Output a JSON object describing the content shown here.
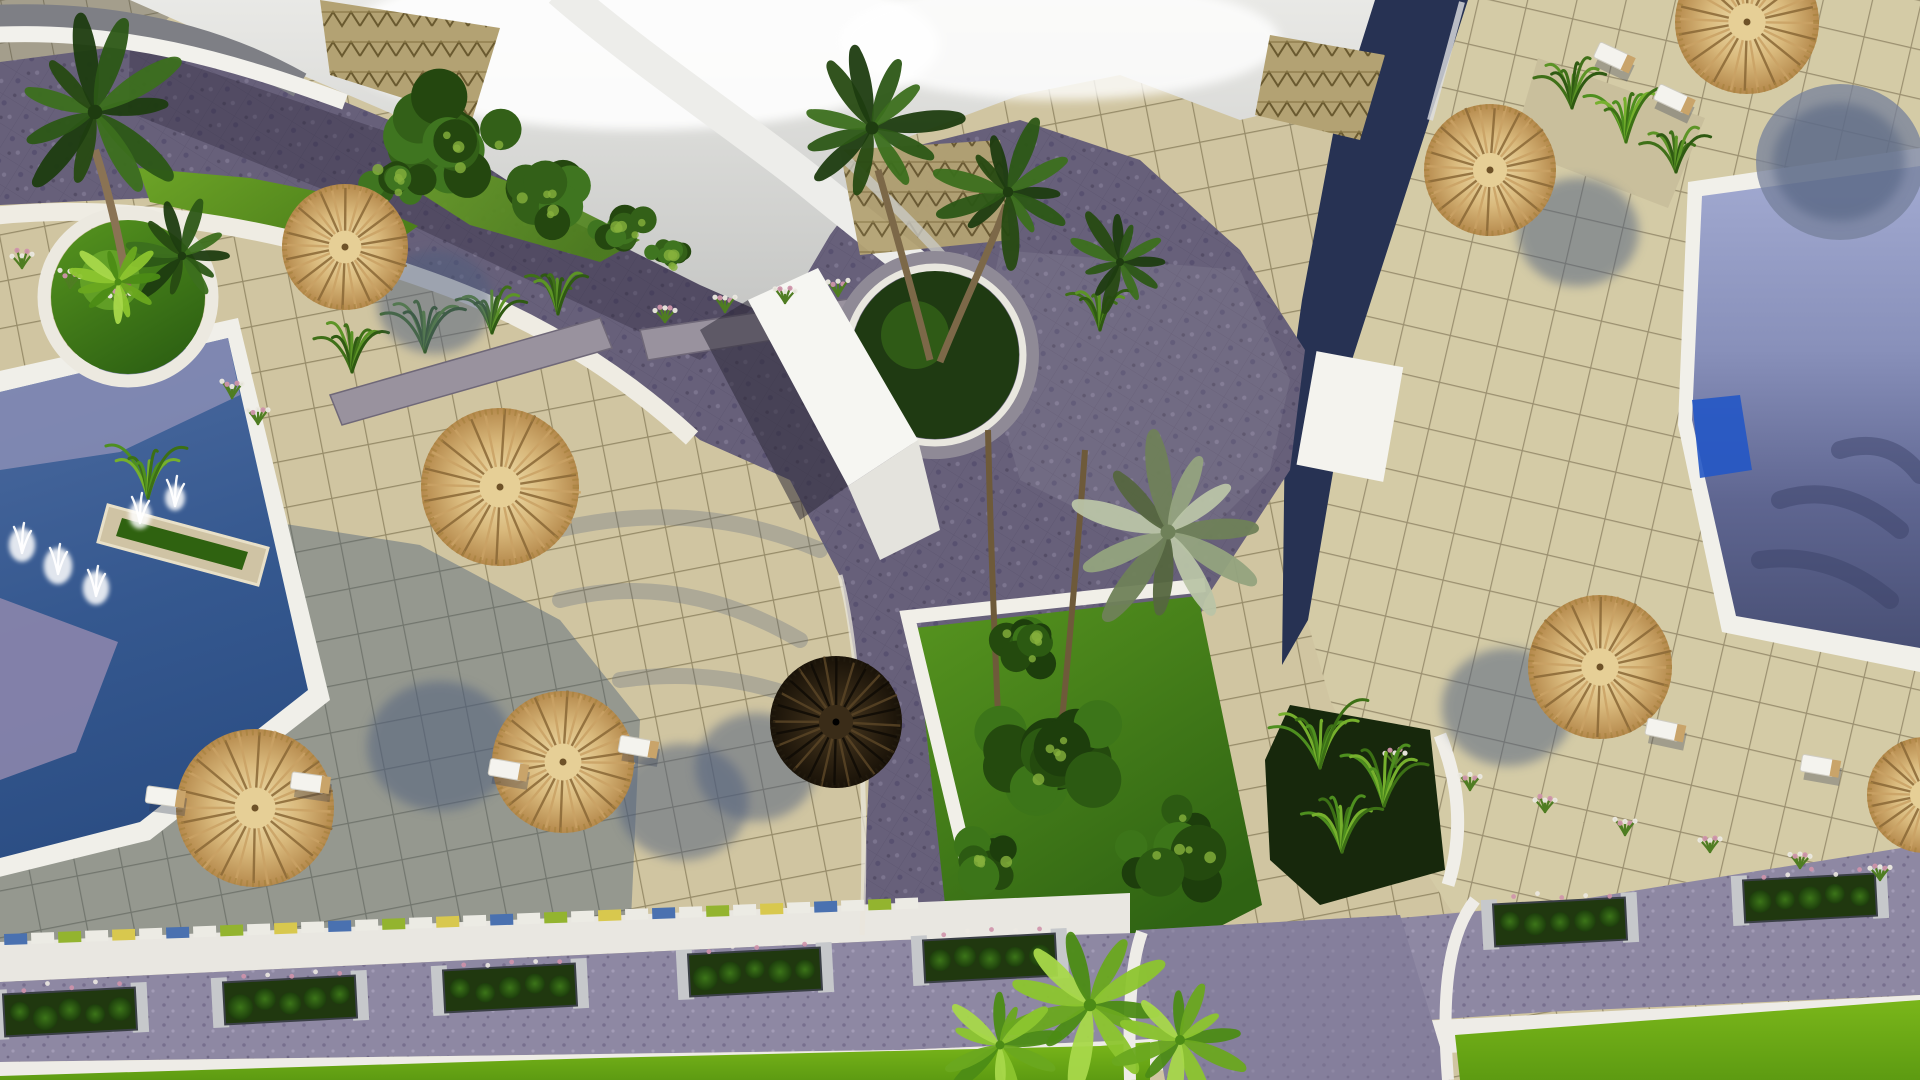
{
  "meta": {
    "title": "aerial-3d-render-resort-pools",
    "description": "Top-down architectural rendering of a resort courtyard with swimming pools, thatched parasols, palm trees, tiled terraces, cobblestone walkways and a landscaped road"
  },
  "palette": {
    "tile_beige": "#cdc29c",
    "tile_grout": "#978c69",
    "tile_right": "#d4cba6",
    "cobble": "#67607a",
    "road": "#8e88a3",
    "navy_path": "#273253",
    "white_curb": "#efede6",
    "pool_deep": "#2d4f86",
    "pool_light": "#9aa2ca",
    "pool_lavender": "#8d90b6",
    "lawn": "#67a024",
    "lawn_bright": "#6fae14",
    "garden": "#2f6313",
    "straw_light": "#efe0ae",
    "straw_dark": "#b5894c",
    "umbrella_spoke_dark": "#8a6836",
    "umbrella_spoke_light": "#caa265",
    "roof_tan": "#b3a273",
    "sky": "#d8d8d5",
    "tree": [
      "#24470f",
      "#336018",
      "#3f7520"
    ],
    "palm": {
      "dark": [
        "#1e3c10",
        "#2c5716",
        "#3c6f1d",
        "#274a12"
      ],
      "silver": [
        "#6f8159",
        "#93a37e",
        "#b9c4a6",
        "#55663f"
      ],
      "bright": [
        "#4c8c15",
        "#6aa81f",
        "#8cc52e",
        "#a8d84a"
      ],
      "garden": [
        "#1d3e0c",
        "#2c5a12",
        "#3c7519",
        "#244a0e"
      ]
    },
    "fern": [
      "#3f7018",
      "#5c9426",
      "#2f5a12"
    ],
    "fern_bright": [
      "#4e8f1f",
      "#76b02d",
      "#3c7015"
    ],
    "flower_pink": "#cf93ab",
    "flower_white": "#ece9e2",
    "trim_colors": [
      "#4a71b0",
      "#ecebe4",
      "#93b42f",
      "#ecebe4",
      "#d8c84e",
      "#ecebe4"
    ]
  },
  "scene": {
    "umbrellas": [
      {
        "x": 345,
        "y": 247,
        "r": 63,
        "style": "straw",
        "sh": [
          90,
          55
        ]
      },
      {
        "x": 500,
        "y": 487,
        "r": 79,
        "style": "straw",
        "sh": [
          0,
          0
        ]
      },
      {
        "x": 255,
        "y": 808,
        "r": 79,
        "style": "straw",
        "sh": [
          185,
          -62
        ]
      },
      {
        "x": 563,
        "y": 762,
        "r": 71,
        "style": "straw",
        "sh": [
          120,
          40
        ]
      },
      {
        "x": 836,
        "y": 722,
        "r": 66,
        "style": "dark",
        "sh": [
          -80,
          45
        ]
      },
      {
        "x": 1490,
        "y": 170,
        "r": 66,
        "style": "straw",
        "sh": [
          88,
          62
        ]
      },
      {
        "x": 1747,
        "y": 22,
        "r": 72,
        "style": "straw",
        "sh": [
          92,
          140
        ]
      },
      {
        "x": 1600,
        "y": 667,
        "r": 72,
        "style": "straw",
        "sh": [
          -92,
          40
        ]
      },
      {
        "x": 1925,
        "y": 795,
        "r": 58,
        "style": "straw",
        "sh": [
          0,
          0
        ]
      }
    ],
    "loungers": [
      {
        "x": 163,
        "y": 797,
        "rot": 8
      },
      {
        "x": 308,
        "y": 783,
        "rot": 8
      },
      {
        "x": 506,
        "y": 770,
        "rot": 10
      },
      {
        "x": 636,
        "y": 747,
        "rot": 10
      },
      {
        "x": 1612,
        "y": 57,
        "rot": 25
      },
      {
        "x": 1672,
        "y": 99,
        "rot": 25
      },
      {
        "x": 1663,
        "y": 730,
        "rot": 12
      },
      {
        "x": 1818,
        "y": 766,
        "rot": 10
      }
    ],
    "road_planters": [
      {
        "x": 70,
        "y": 1012
      },
      {
        "x": 290,
        "y": 1000
      },
      {
        "x": 510,
        "y": 988
      },
      {
        "x": 755,
        "y": 972
      },
      {
        "x": 990,
        "y": 958
      },
      {
        "x": 1560,
        "y": 922
      },
      {
        "x": 1810,
        "y": 898
      }
    ],
    "trim_strip": {
      "x0": 4,
      "y0": 934,
      "x1": 900,
      "slope": -0.04,
      "step": 27
    },
    "flower_tufts": [
      {
        "x": 22,
        "y": 268
      },
      {
        "x": 70,
        "y": 288
      },
      {
        "x": 120,
        "y": 308
      },
      {
        "x": 232,
        "y": 398
      },
      {
        "x": 258,
        "y": 424
      },
      {
        "x": 665,
        "y": 322
      },
      {
        "x": 725,
        "y": 312
      },
      {
        "x": 785,
        "y": 303
      },
      {
        "x": 838,
        "y": 296
      },
      {
        "x": 1395,
        "y": 765
      },
      {
        "x": 1470,
        "y": 790
      },
      {
        "x": 1545,
        "y": 812
      },
      {
        "x": 1625,
        "y": 835
      },
      {
        "x": 1710,
        "y": 852
      },
      {
        "x": 1800,
        "y": 868
      },
      {
        "x": 1880,
        "y": 880
      }
    ],
    "ferns": [
      {
        "x": 352,
        "y": 372,
        "s": 1.3,
        "pal": "fern"
      },
      {
        "x": 425,
        "y": 352,
        "s": 1.5,
        "pal": "fern"
      },
      {
        "x": 492,
        "y": 333,
        "s": 1.3,
        "pal": "fern"
      },
      {
        "x": 558,
        "y": 314,
        "s": 1.1,
        "pal": "fern"
      },
      {
        "x": 148,
        "y": 498,
        "s": 1.4,
        "pal": "fern_bright"
      },
      {
        "x": 1320,
        "y": 768,
        "s": 1.8,
        "pal": "fern_bright"
      },
      {
        "x": 1384,
        "y": 806,
        "s": 1.6,
        "pal": "fern_bright"
      },
      {
        "x": 1342,
        "y": 852,
        "s": 1.5,
        "pal": "fern_bright"
      },
      {
        "x": 1572,
        "y": 108,
        "s": 1.3,
        "pal": "fern"
      },
      {
        "x": 1626,
        "y": 142,
        "s": 1.4,
        "pal": "fern_bright"
      },
      {
        "x": 1676,
        "y": 172,
        "s": 1.2,
        "pal": "fern"
      },
      {
        "x": 1100,
        "y": 330,
        "s": 1.2,
        "pal": "fern"
      }
    ],
    "tree_clusters": [
      {
        "x": 455,
        "y": 140,
        "r": 78,
        "pal": "tree"
      },
      {
        "x": 548,
        "y": 192,
        "r": 56,
        "pal": "tree"
      },
      {
        "x": 622,
        "y": 228,
        "r": 44,
        "pal": "tree"
      },
      {
        "x": 398,
        "y": 178,
        "r": 40,
        "pal": "tree"
      },
      {
        "x": 672,
        "y": 255,
        "r": 32,
        "pal": "tree"
      },
      {
        "x": 1060,
        "y": 750,
        "r": 90,
        "pal": "garden"
      },
      {
        "x": 1180,
        "y": 850,
        "r": 70,
        "pal": "garden"
      },
      {
        "x": 980,
        "y": 860,
        "r": 55,
        "pal": "garden"
      },
      {
        "x": 1035,
        "y": 640,
        "r": 50,
        "pal": "garden"
      }
    ],
    "palm_canopies": [
      {
        "x": 95,
        "y": 112,
        "s": 1.45,
        "pal": "dark"
      },
      {
        "x": 182,
        "y": 256,
        "s": 0.85,
        "pal": "dark"
      },
      {
        "x": 872,
        "y": 128,
        "s": 1.3,
        "pal": "dark"
      },
      {
        "x": 1008,
        "y": 192,
        "s": 1.05,
        "pal": "dark"
      },
      {
        "x": 1120,
        "y": 262,
        "s": 0.8,
        "pal": "dark"
      },
      {
        "x": 1168,
        "y": 532,
        "s": 1.5,
        "pal": "silver"
      },
      {
        "x": 1090,
        "y": 1005,
        "s": 1.25,
        "pal": "bright"
      },
      {
        "x": 1000,
        "y": 1045,
        "s": 0.9,
        "pal": "bright"
      },
      {
        "x": 1180,
        "y": 1040,
        "s": 1.0,
        "pal": "bright"
      },
      {
        "x": 118,
        "y": 282,
        "s": 0.7,
        "pal": "bright"
      }
    ],
    "fountain_jets": [
      {
        "x": 22,
        "y": 545,
        "s": 1.2
      },
      {
        "x": 58,
        "y": 566,
        "s": 1.3
      },
      {
        "x": 96,
        "y": 588,
        "s": 1.2
      },
      {
        "x": 140,
        "y": 515,
        "s": 1.0
      },
      {
        "x": 175,
        "y": 498,
        "s": 0.9
      }
    ]
  }
}
